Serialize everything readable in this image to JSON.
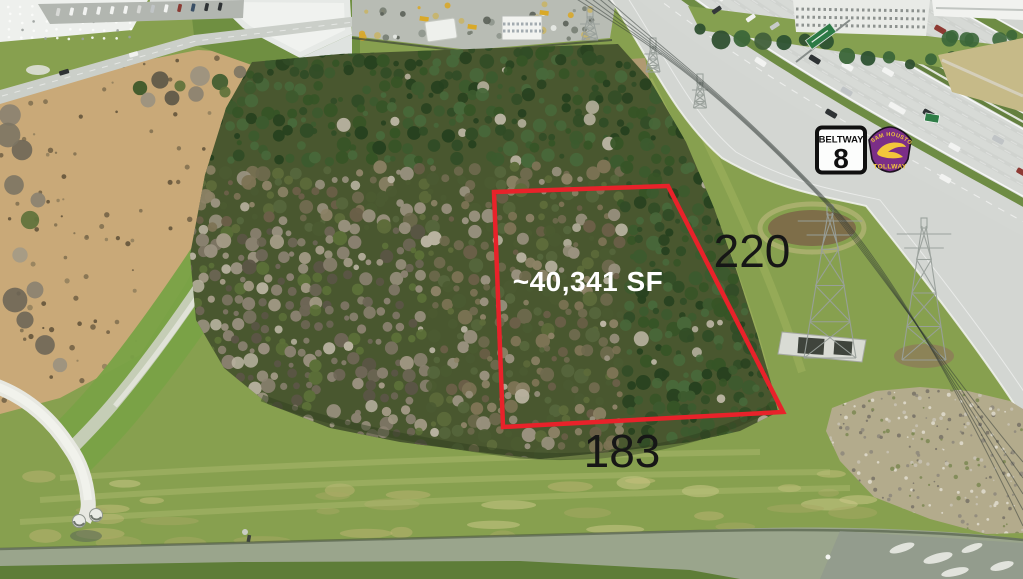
{
  "image": {
    "type": "aerial-drone-photo",
    "subject": "wooded land parcel beside Beltway 8 feeder and Sam Houston Tollway"
  },
  "annotations": {
    "area_label": "~40,341 SF",
    "dim_right": "220",
    "dim_bottom": "183",
    "outline_color": "#e8222a",
    "area_text_color": "#ffffff",
    "dim_text_color": "#161616"
  },
  "signs": {
    "beltway8": {
      "name": "BELTWAY",
      "number": "8",
      "bg": "#fcfdfc",
      "border": "#101010"
    },
    "tollway": {
      "line1": "SAM HOUSTON",
      "line2": "TOLLWAY",
      "shield": "#7b2e87",
      "accent": "#f2c63b"
    }
  },
  "palette": {
    "grass": "#87a04f",
    "bank_grass": "#7ca043",
    "dirt": "#c9a978",
    "forest_base": "#49572f",
    "pavement": "#d3d6d2",
    "water": "#9aa58c",
    "rock": "#b3ab8c",
    "pond_liner": "#e6e9e6",
    "median_green": "#64803f"
  }
}
